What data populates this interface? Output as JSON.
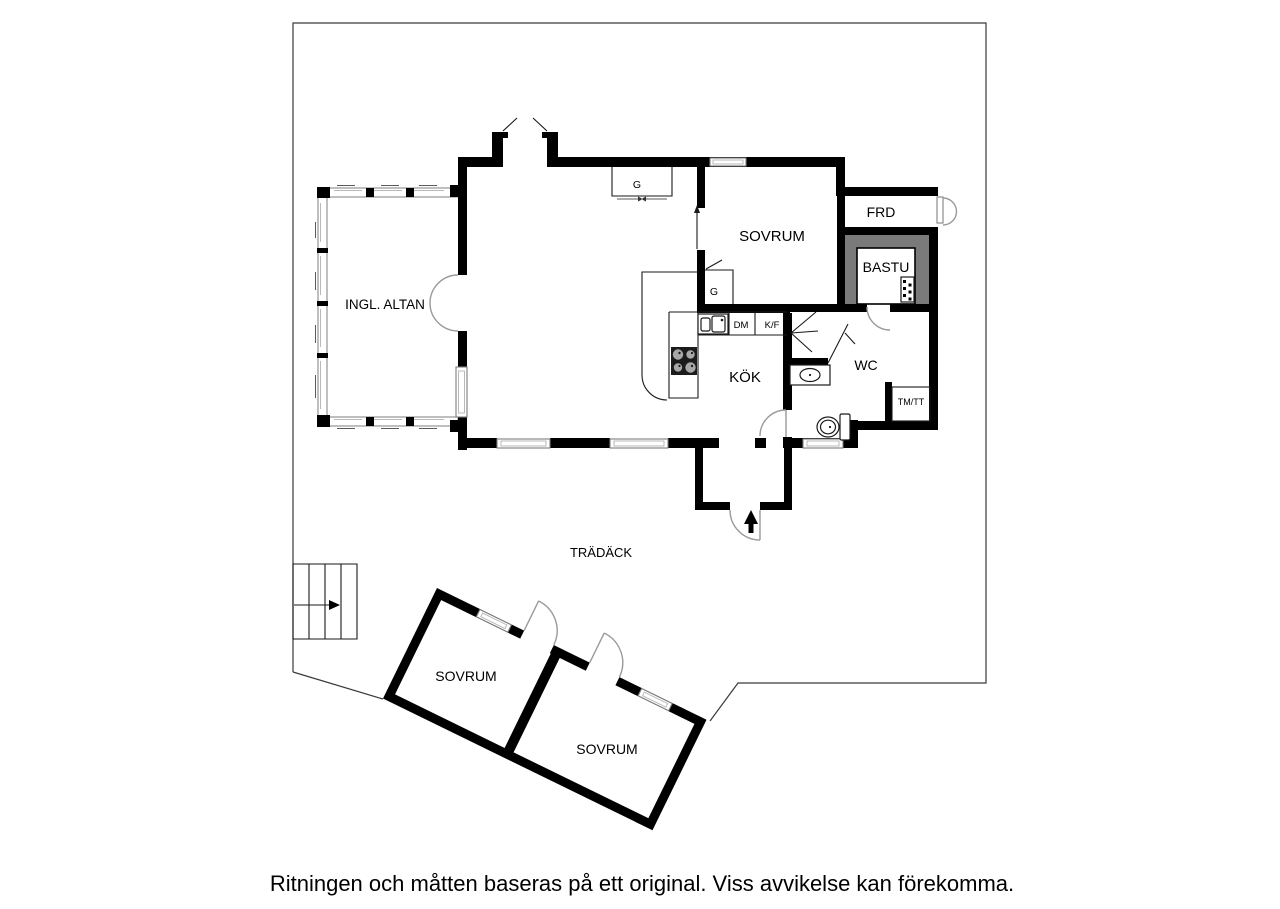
{
  "caption": "Ritningen och måtten baseras på ett original. Viss avvikelse kan förekomma.",
  "floorplan": {
    "rooms": {
      "ingl_altan": "INGL. ALTAN",
      "sovrum_main": "SOVRUM",
      "frd": "FRD",
      "bastu": "BASTU",
      "wc": "WC",
      "kok": "KÖK",
      "sovrum_guest_left": "SOVRUM",
      "sovrum_guest_right": "SOVRUM"
    },
    "areas": {
      "tradack": "TRÄDÄCK"
    },
    "closets": {
      "g_hall": "G",
      "g_kitchen": "G"
    },
    "appliances": {
      "dishwasher": "DM",
      "fridge_freezer": "K/F",
      "washer_dryer": "TM/TT"
    },
    "icons": {
      "entrance_arrow": "solid-up-arrow",
      "stairs_arrow": "right-arrow",
      "stove": "four-burner-cooktop",
      "kitchen_sink": "double-basin-sink",
      "wc_sink": "oval-basin",
      "toilet": "toilet-with-tank",
      "sauna_heater": "dotted-heater-box",
      "fireplace": "open-hearth-chimney"
    },
    "colors": {
      "walls": "#000000",
      "sauna_wall": "#7a7a7a",
      "door_arc": "#9a9a9a",
      "window_frame": "#7e7e7e",
      "boundary": "#3a3a3a",
      "background": "#ffffff",
      "stove_plate": "#1c1c1c",
      "burner": "#a8a8a8"
    }
  }
}
